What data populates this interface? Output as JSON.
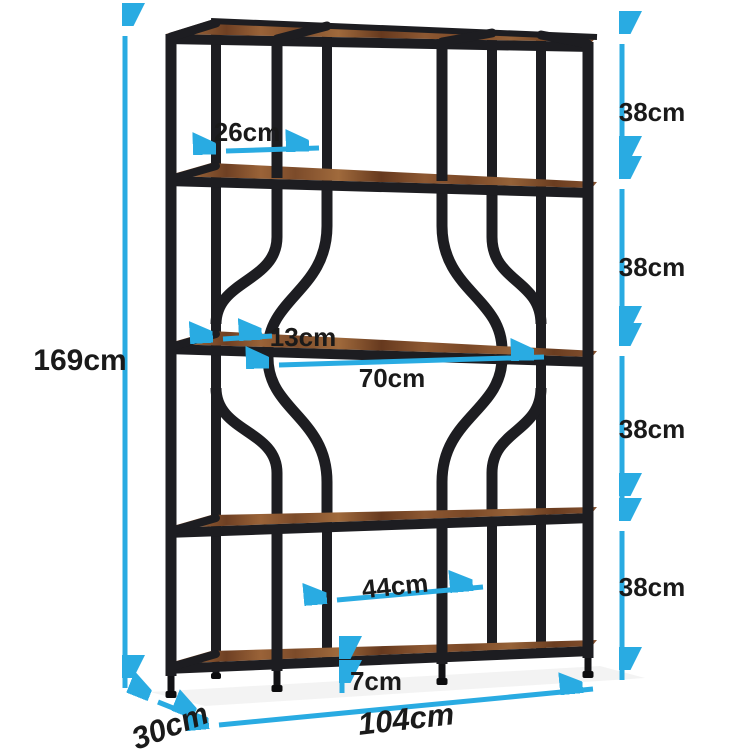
{
  "image": {
    "kind": "product-dimension-diagram",
    "product": "industrial-etagere-bookshelf-with-circle-accent"
  },
  "colors": {
    "accent": "#29abe2",
    "frame": "#1d1d21",
    "wood": "#8a5531",
    "label": "#1a1a1a",
    "background": "#ffffff"
  },
  "dimensions": {
    "total_height": "169cm",
    "side_bay_width": "26cm",
    "tier_gap_1": "38cm",
    "tier_gap_2": "38cm",
    "tier_gap_3": "38cm",
    "tier_gap_4": "38cm",
    "arc_inset": "13cm",
    "center_bay_width": "70cm",
    "lower_center_span": "44cm",
    "bottom_shelf_clearance": "7cm",
    "total_width": "104cm",
    "depth": "30cm"
  }
}
